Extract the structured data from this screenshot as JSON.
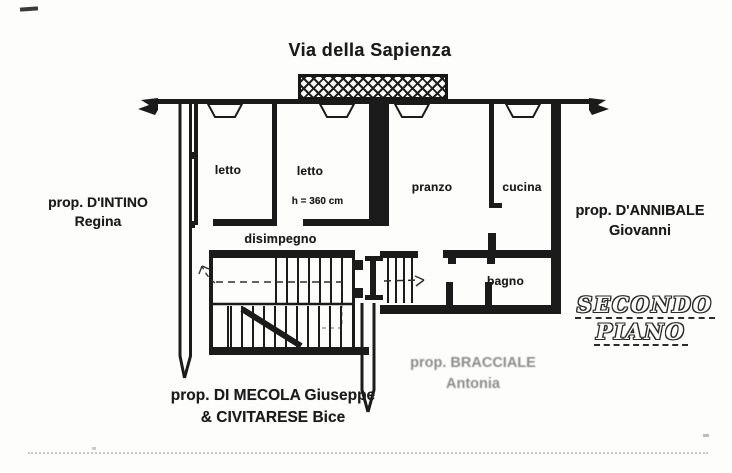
{
  "street_label": "Via della Sapienza",
  "floor_label": {
    "line1": "SECONDO",
    "line2": "PIANO"
  },
  "rooms": {
    "letto_left": "letto",
    "letto_right": "letto",
    "ceiling_height": "h = 360 cm",
    "pranzo": "pranzo",
    "cucina": "cucina",
    "disimpegno": "disimpegno",
    "bagno": "bagno"
  },
  "owners": {
    "west": {
      "line1": "prop. D'INTINO",
      "line2": "Regina"
    },
    "east": {
      "line1": "prop. D'ANNIBALE",
      "line2": "Giovanni"
    },
    "south": {
      "line1": "prop. DI MECOLA Giuseppe",
      "line2": "& CIVITARESE Bice"
    },
    "south_east": {
      "line1": "prop. BRACCIALE",
      "line2": "Antonia"
    }
  },
  "colors": {
    "ink": "#1b1b1b",
    "paper": "#fdfdfc",
    "faded_ink": "#8d8d87"
  }
}
